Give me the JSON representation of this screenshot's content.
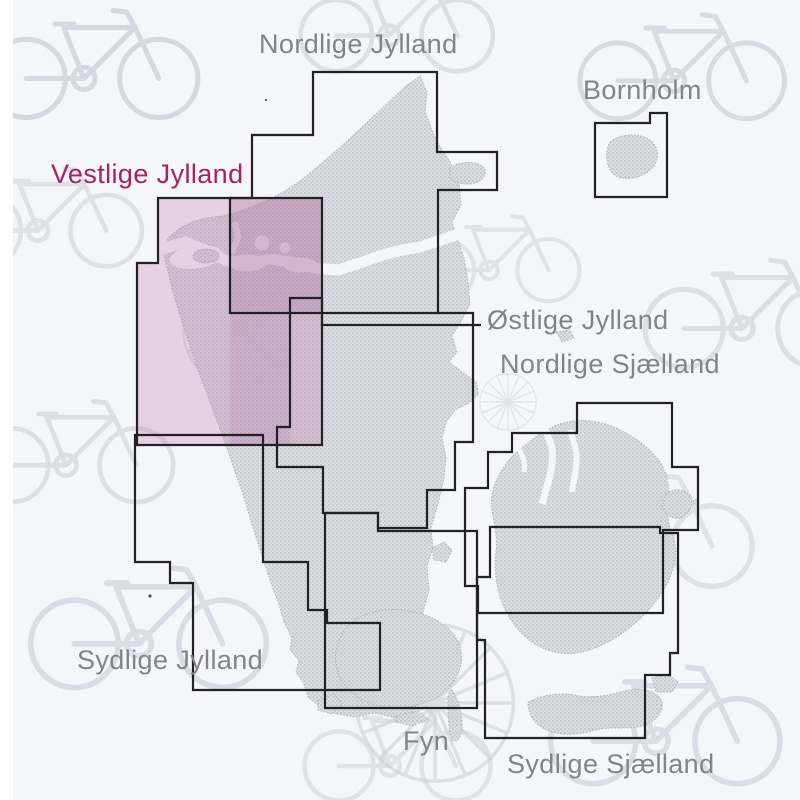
{
  "page": {
    "kind": "cycling-map-index-of-denmark",
    "highlighted_region": "Vestlige Jylland"
  },
  "regions": [
    {
      "id": "nordlige-jylland",
      "label": "Nordlige Jylland",
      "highlighted": false
    },
    {
      "id": "bornholm",
      "label": "Bornholm",
      "highlighted": false
    },
    {
      "id": "vestlige-jylland",
      "label": "Vestlige Jylland",
      "highlighted": true
    },
    {
      "id": "oestlige-jylland",
      "label": "Østlige Jylland",
      "highlighted": false
    },
    {
      "id": "nordlige-sjaelland",
      "label": "Nordlige Sjælland",
      "highlighted": false
    },
    {
      "id": "sydlige-jylland",
      "label": "Sydlige Jylland",
      "highlighted": false
    },
    {
      "id": "fyn",
      "label": "Fyn",
      "highlighted": false
    },
    {
      "id": "sydlige-sjaelland",
      "label": "Sydlige Sjælland",
      "highlighted": false
    }
  ],
  "colors": {
    "label_gray": "#83838a",
    "highlight_magenta": "#a92063",
    "sheet_outline": "#222226",
    "land_fill": "#d9dbe0",
    "land_dot": "#b4b7c0",
    "land_edge": "#aeb1bb",
    "sea_background": "#f5f6f9",
    "page_margin": "#ffffff",
    "highlight_fill": "#c478ad",
    "highlight_overlap_fill": "#9a5a8f",
    "bicycle_line": "#ccd0db"
  }
}
